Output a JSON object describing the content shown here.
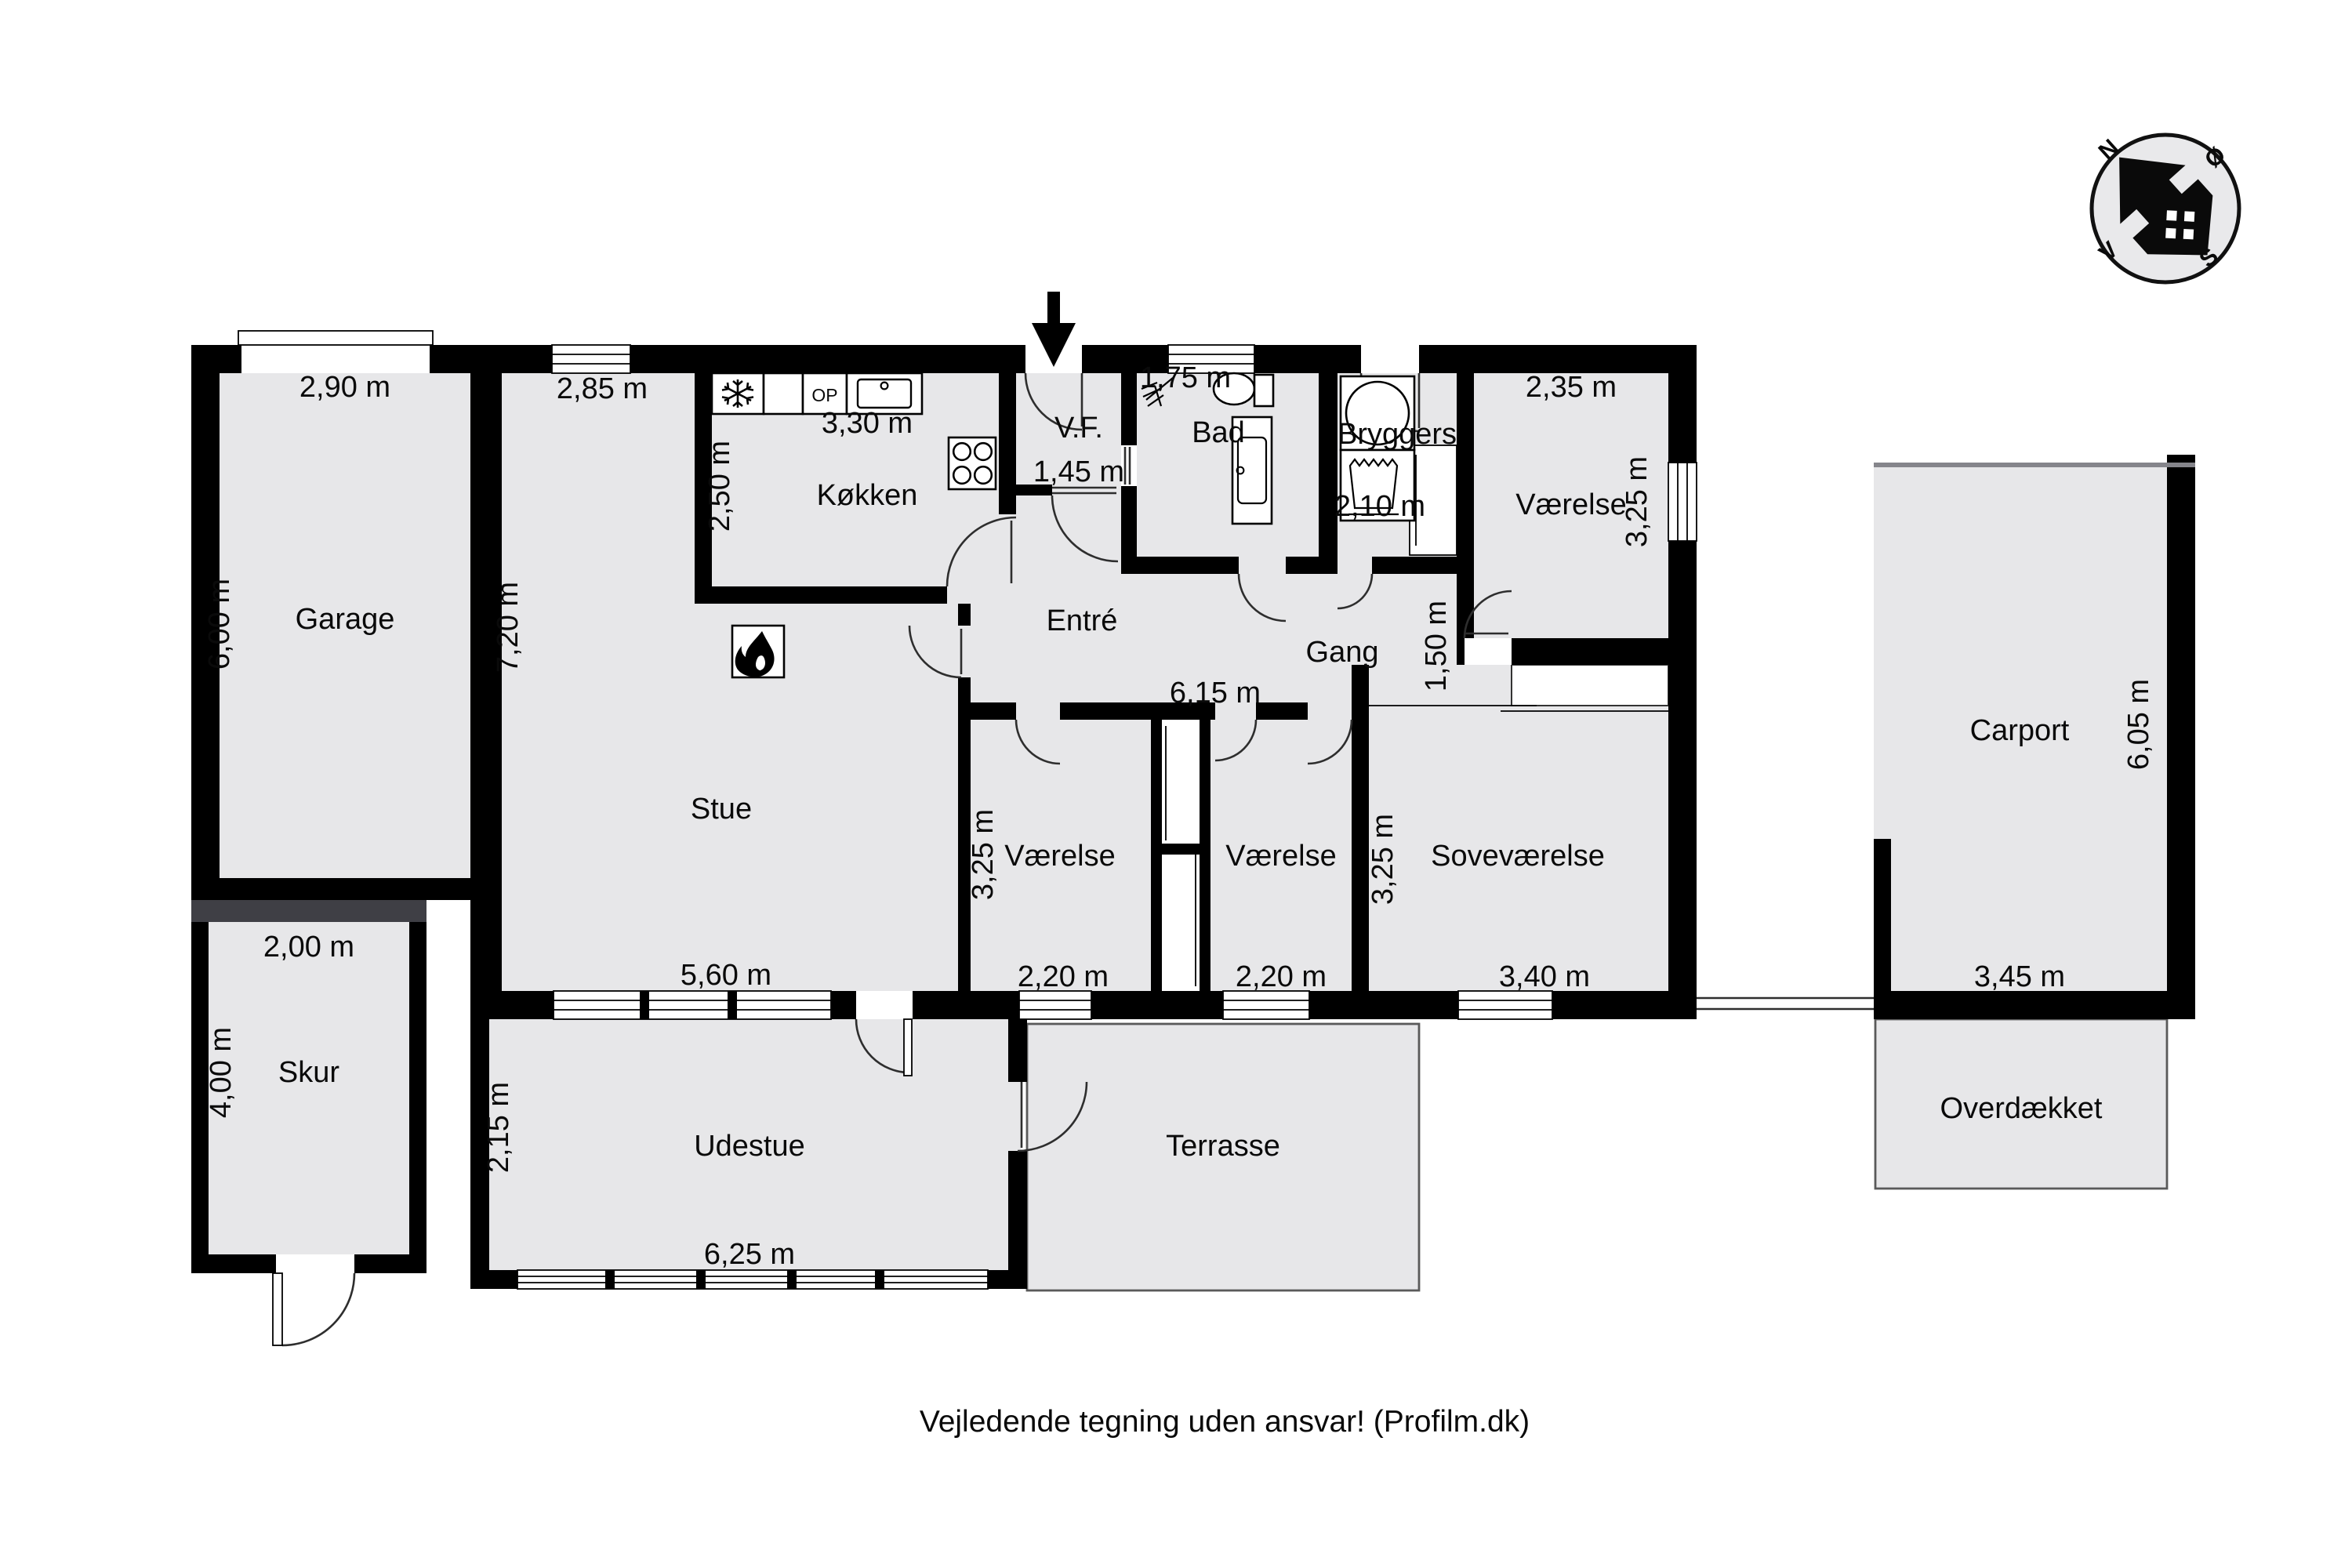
{
  "rooms": {
    "garage": {
      "name": "Garage",
      "w": "2,90 m",
      "h": "6,00 m"
    },
    "stue": {
      "name": "Stue",
      "w_top": "2,85 m",
      "h": "7,20 m",
      "w_bottom": "5,60 m"
    },
    "koekken": {
      "name": "Køkken",
      "w": "3,30 m",
      "h": "2,50 m",
      "oven": "OP"
    },
    "vf": {
      "name": "V.F.",
      "w": "1,45 m"
    },
    "bad": {
      "name": "Bad",
      "w": "1,75 m"
    },
    "bryggers": {
      "name": "Bryggers",
      "w": "2,10 m"
    },
    "vaerelse_ne": {
      "name": "Værelse",
      "w": "2,35 m",
      "h": "3,25 m"
    },
    "entre": {
      "name": "Entré"
    },
    "gang": {
      "name": "Gang",
      "w": "6,15 m",
      "h": "1,50 m"
    },
    "vaerelse_v1": {
      "name": "Værelse",
      "w": "2,20 m",
      "h": "3,25 m"
    },
    "vaerelse_v2": {
      "name": "Værelse",
      "w": "2,20 m"
    },
    "sovevaerelse": {
      "name": "Soveværelse",
      "w": "3,40 m",
      "h": "3,25 m"
    },
    "skur": {
      "name": "Skur",
      "w": "2,00 m",
      "h": "4,00 m"
    },
    "udestue": {
      "name": "Udestue",
      "w": "6,25 m",
      "h": "2,15 m"
    },
    "terrasse": {
      "name": "Terrasse"
    },
    "carport": {
      "name": "Carport",
      "w": "3,45 m",
      "h": "6,05 m"
    },
    "overdaekket": {
      "name": "Overdækket"
    }
  },
  "compass": {
    "north": "N",
    "east": "Ø",
    "south": "S",
    "west": "V"
  },
  "footer": {
    "text": "Vejledende tegning uden ansvar! (Profilm.dk)"
  },
  "colors": {
    "wall": "#000000",
    "room_fill": "#e7e7e9",
    "outdoor_stroke": "#5a5a5a",
    "divider_dark": "#3f3f45"
  }
}
